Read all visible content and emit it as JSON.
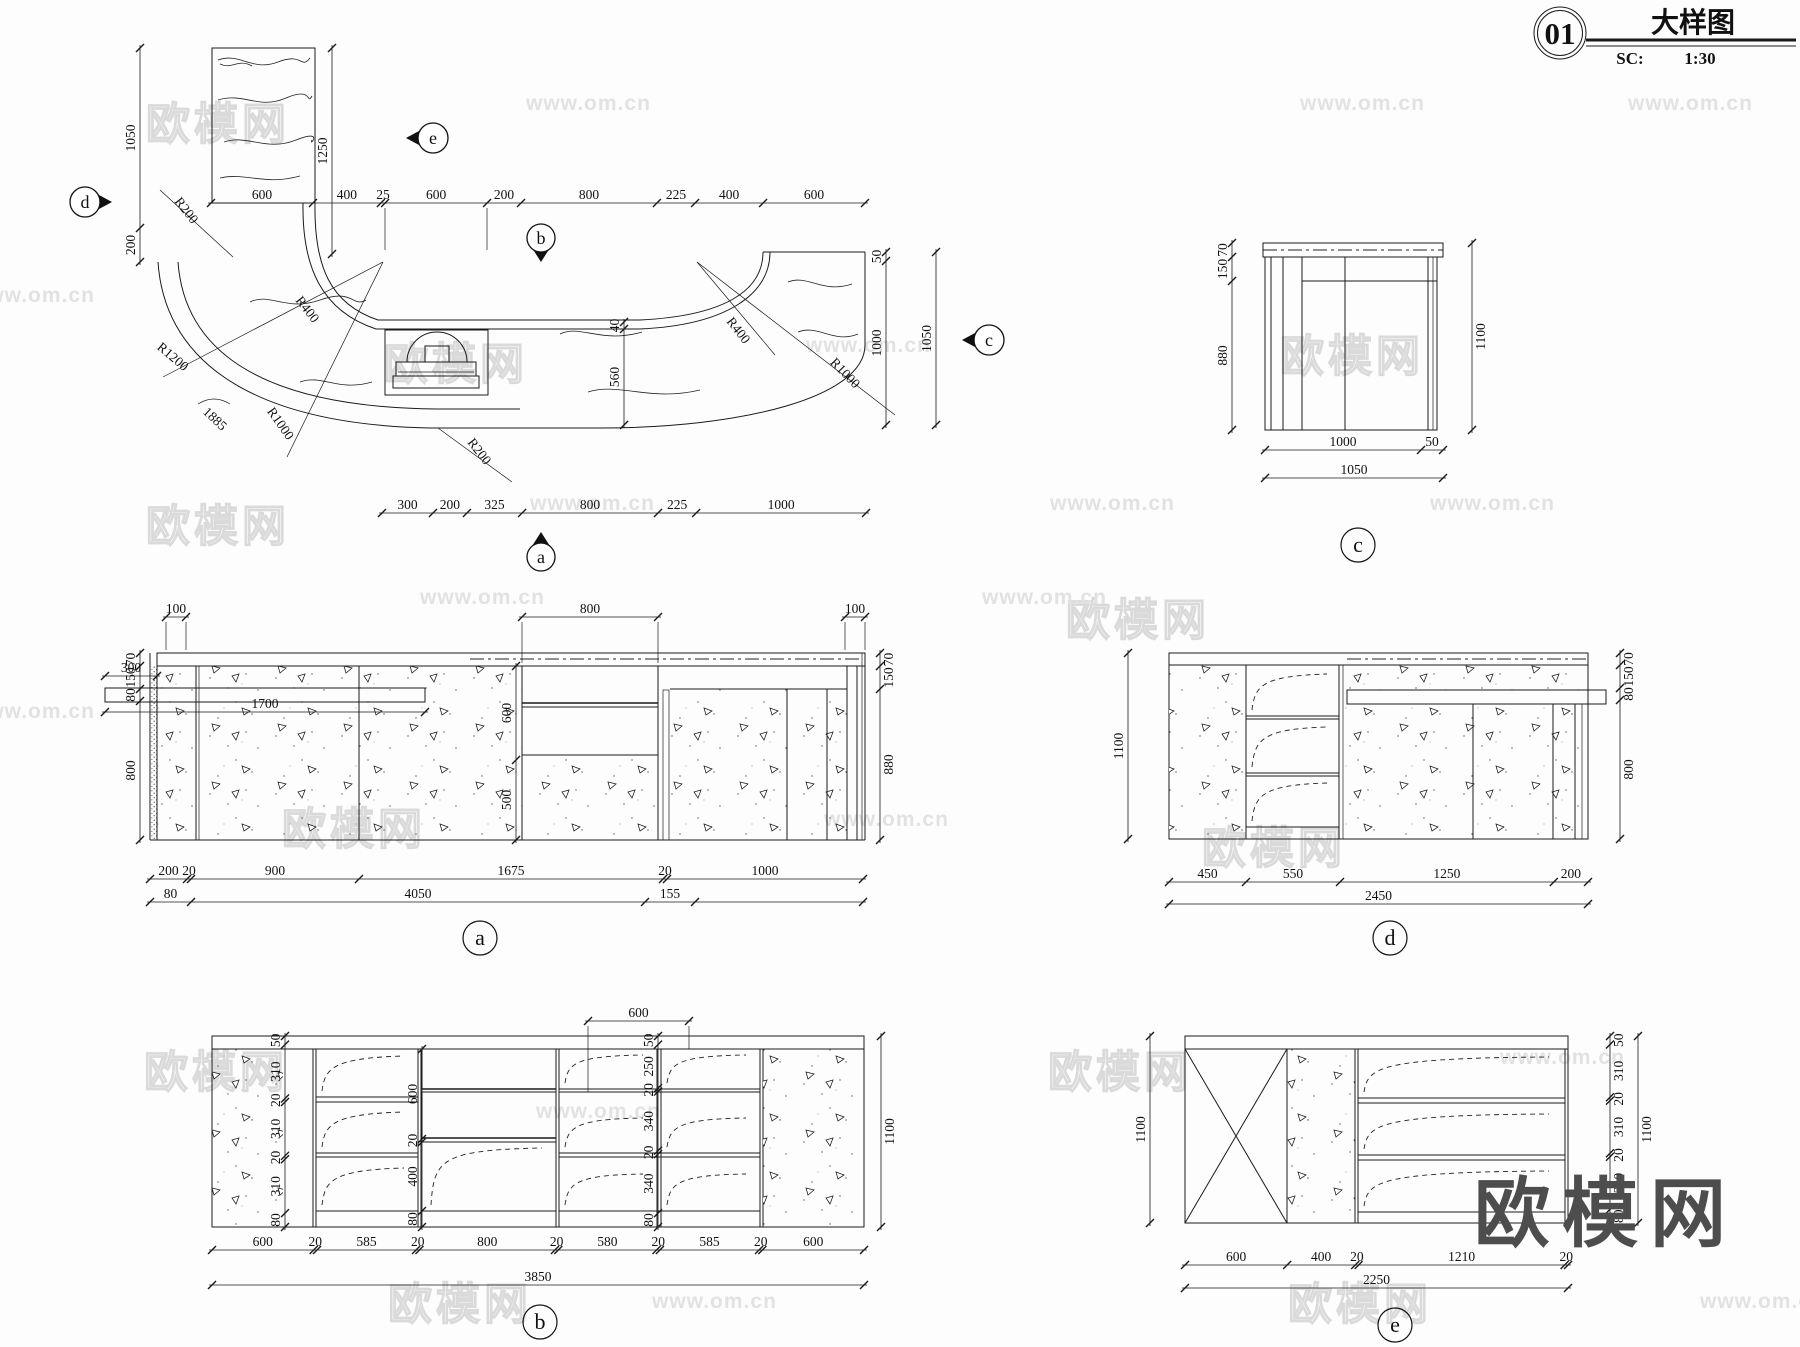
{
  "title_block": {
    "number": "01",
    "name": "大样图",
    "scale_label": "SC:",
    "scale": "1:30"
  },
  "watermark": {
    "brand": "欧模网",
    "site": "www.om.cn",
    "site_short": "om.cn"
  },
  "plan": {
    "markers": {
      "a": "a",
      "b": "b",
      "c": "c",
      "d": "d",
      "e": "e"
    },
    "dims": {
      "top": [
        "600",
        "400",
        "25",
        "600",
        "200",
        "800",
        "225",
        "400",
        "600"
      ],
      "bottom": [
        "300",
        "200",
        "325",
        "800",
        "225",
        "1000"
      ],
      "left": [
        "1050",
        "200"
      ],
      "column_height": [
        "1250"
      ],
      "counter_depth": [
        "40",
        "560"
      ],
      "right_inner": [
        "50",
        "1000"
      ],
      "right_total": [
        "1050"
      ]
    },
    "radii": {
      "r200_top": "R200",
      "r1200": "R1200",
      "r400_left": "R400",
      "r1000_left": "R1000",
      "arc_length": "1885",
      "r200_bottom": "R200",
      "r400_right": "R400",
      "r1000_right": "R1000"
    }
  },
  "views": {
    "a": {
      "label": "a",
      "dims": {
        "top_left": [
          "100"
        ],
        "top_mid": [
          "800"
        ],
        "top_right": [
          "100"
        ],
        "left": [
          "70",
          "150",
          "80",
          "800"
        ],
        "shelf_depth": [
          "300"
        ],
        "shelf_length": [
          "1700"
        ],
        "glass": [
          "600",
          "500"
        ],
        "right": [
          "70",
          "150",
          "880"
        ],
        "bottom1": [
          "200",
          "20",
          "900",
          "1675",
          "20",
          "1000"
        ],
        "bottom2": [
          "80",
          "4050",
          "155"
        ]
      }
    },
    "b": {
      "label": "b",
      "dims": {
        "top": [
          "600"
        ],
        "left": [
          "50",
          "310",
          "20",
          "310",
          "20",
          "310",
          "80"
        ],
        "mid": [
          "600",
          "20",
          "400",
          "80"
        ],
        "right_inner": [
          "50",
          "250",
          "20",
          "340",
          "20",
          "340",
          "80"
        ],
        "right": [
          "1100"
        ],
        "bottom1": [
          "600",
          "20",
          "585",
          "20",
          "800",
          "20",
          "580",
          "20",
          "585",
          "20",
          "600"
        ],
        "bottom2": [
          "3850"
        ]
      }
    },
    "c": {
      "label": "c",
      "dims": {
        "left": [
          "70",
          "150",
          "880"
        ],
        "right": [
          "1100"
        ],
        "bottom1": [
          "1000",
          "50"
        ],
        "bottom2": [
          "1050"
        ]
      }
    },
    "d": {
      "label": "d",
      "dims": {
        "left": [
          "1100"
        ],
        "right": [
          "70",
          "150",
          "80",
          "800"
        ],
        "bottom1": [
          "450",
          "550",
          "1250",
          "200"
        ],
        "bottom2": [
          "2450"
        ]
      }
    },
    "e": {
      "label": "e",
      "dims": {
        "left": [
          "1100"
        ],
        "right_inner": [
          "50",
          "310",
          "20",
          "310",
          "20",
          "310",
          "80"
        ],
        "right": [
          "1100"
        ],
        "bottom1": [
          "600",
          "400",
          "20",
          "1210",
          "20"
        ],
        "bottom2": [
          "2250"
        ]
      }
    }
  }
}
